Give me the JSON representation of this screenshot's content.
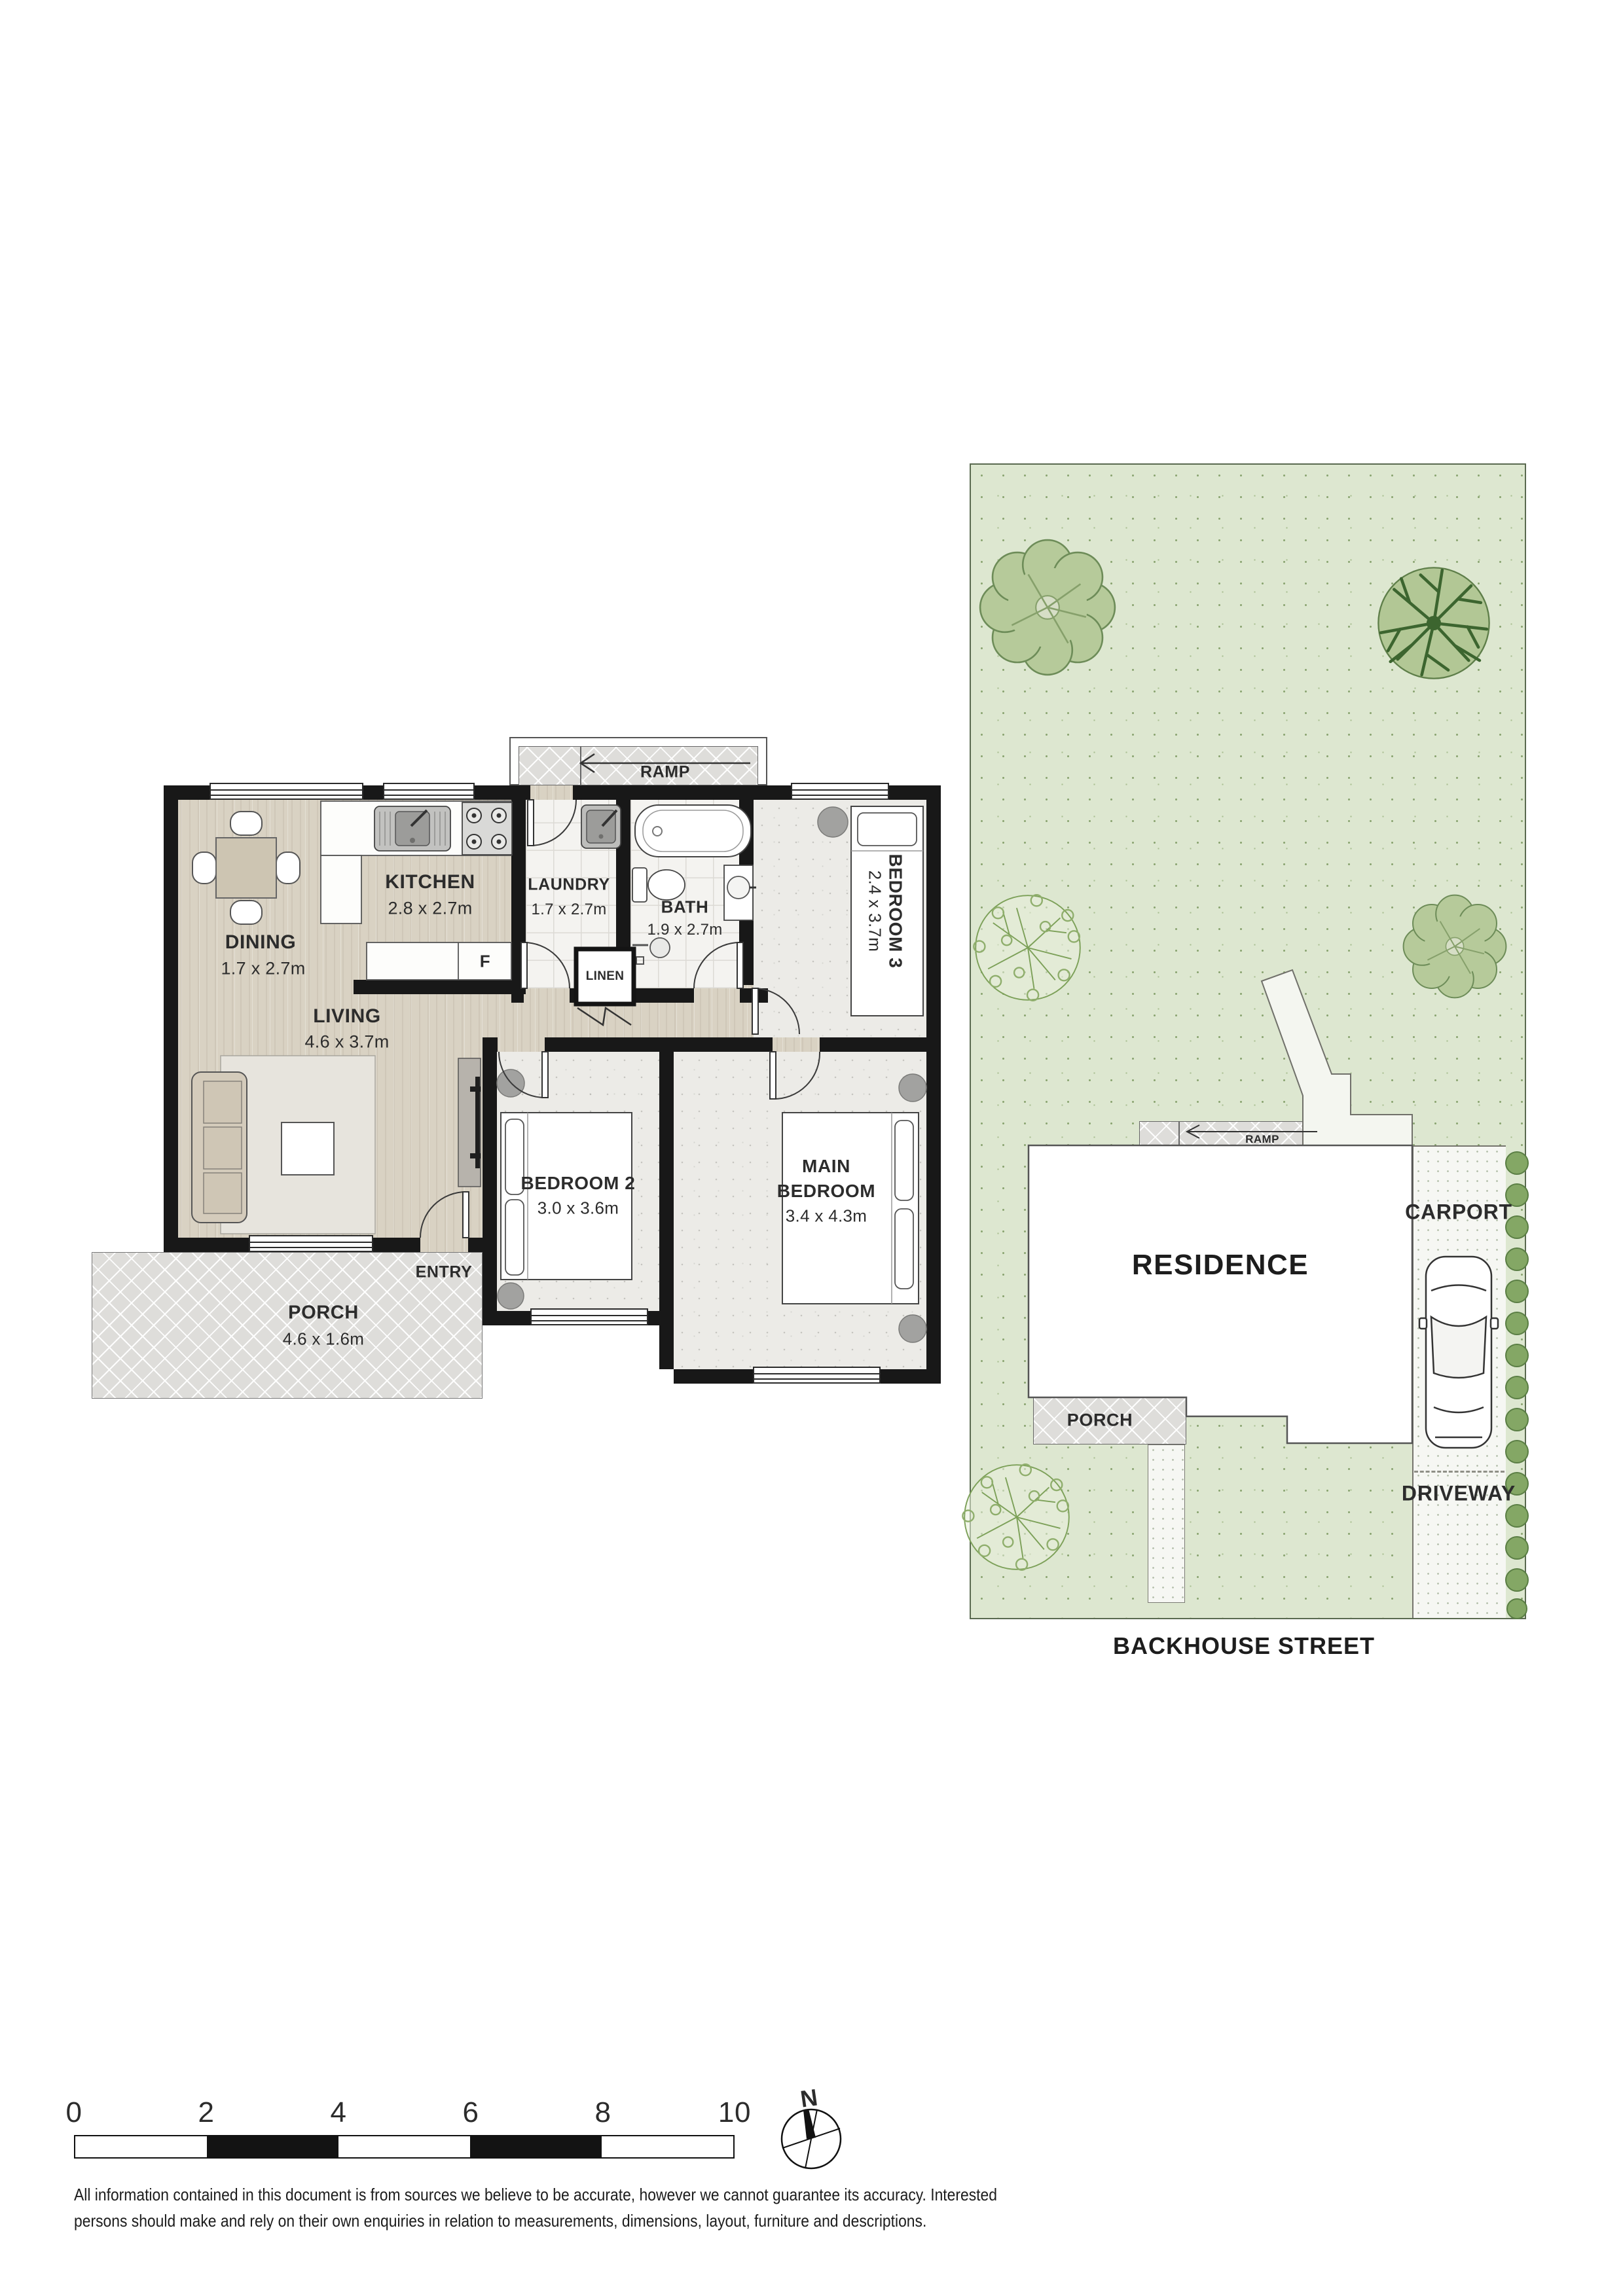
{
  "floorplan": {
    "ramp_label": "RAMP",
    "rooms": {
      "kitchen": {
        "name": "KITCHEN",
        "dims": "2.8 x 2.7m"
      },
      "dining": {
        "name": "DINING",
        "dims": "1.7 x 2.7m"
      },
      "laundry": {
        "name": "LAUNDRY",
        "dims": "1.7 x 2.7m"
      },
      "bath": {
        "name": "BATH",
        "dims": "1.9 x 2.7m"
      },
      "bedroom3": {
        "name": "BEDROOM 3",
        "dims": "2.4 x 3.7m"
      },
      "living": {
        "name": "LIVING",
        "dims": "4.6 x 3.7m"
      },
      "bedroom2": {
        "name": "BEDROOM 2",
        "dims": "3.0 x 3.6m"
      },
      "main_bedroom": {
        "line1": "MAIN",
        "line2": "BEDROOM",
        "dims": "3.4 x 4.3m"
      },
      "porch": {
        "name": "PORCH",
        "dims": "4.6 x 1.6m"
      }
    },
    "labels": {
      "entry": "ENTRY",
      "linen": "LINEN",
      "fridge": "F"
    }
  },
  "siteplan": {
    "residence": "RESIDENCE",
    "carport": "CARPORT",
    "driveway": "DRIVEWAY",
    "porch": "PORCH",
    "ramp": "RAMP",
    "street": "BACKHOUSE STREET"
  },
  "scalebar": {
    "labels": [
      "0",
      "2",
      "4",
      "6",
      "8",
      "10"
    ],
    "compass_north": "N"
  },
  "disclaimer": {
    "line1": "All information contained in this document is from sources we believe to be accurate, however we cannot guarantee its accuracy. Interested",
    "line2": "persons should make and rely on their own enquiries in relation to measurements, dimensions, layout, furniture and descriptions."
  },
  "colors": {
    "wall": "#181818",
    "wood_floor": "#d9d2c3",
    "carpet": "#ecebe7",
    "grass": "#dde7d0",
    "tree_green": "#b6ca9a",
    "hedge_green": "#84a765",
    "paving": "#dedddA"
  }
}
